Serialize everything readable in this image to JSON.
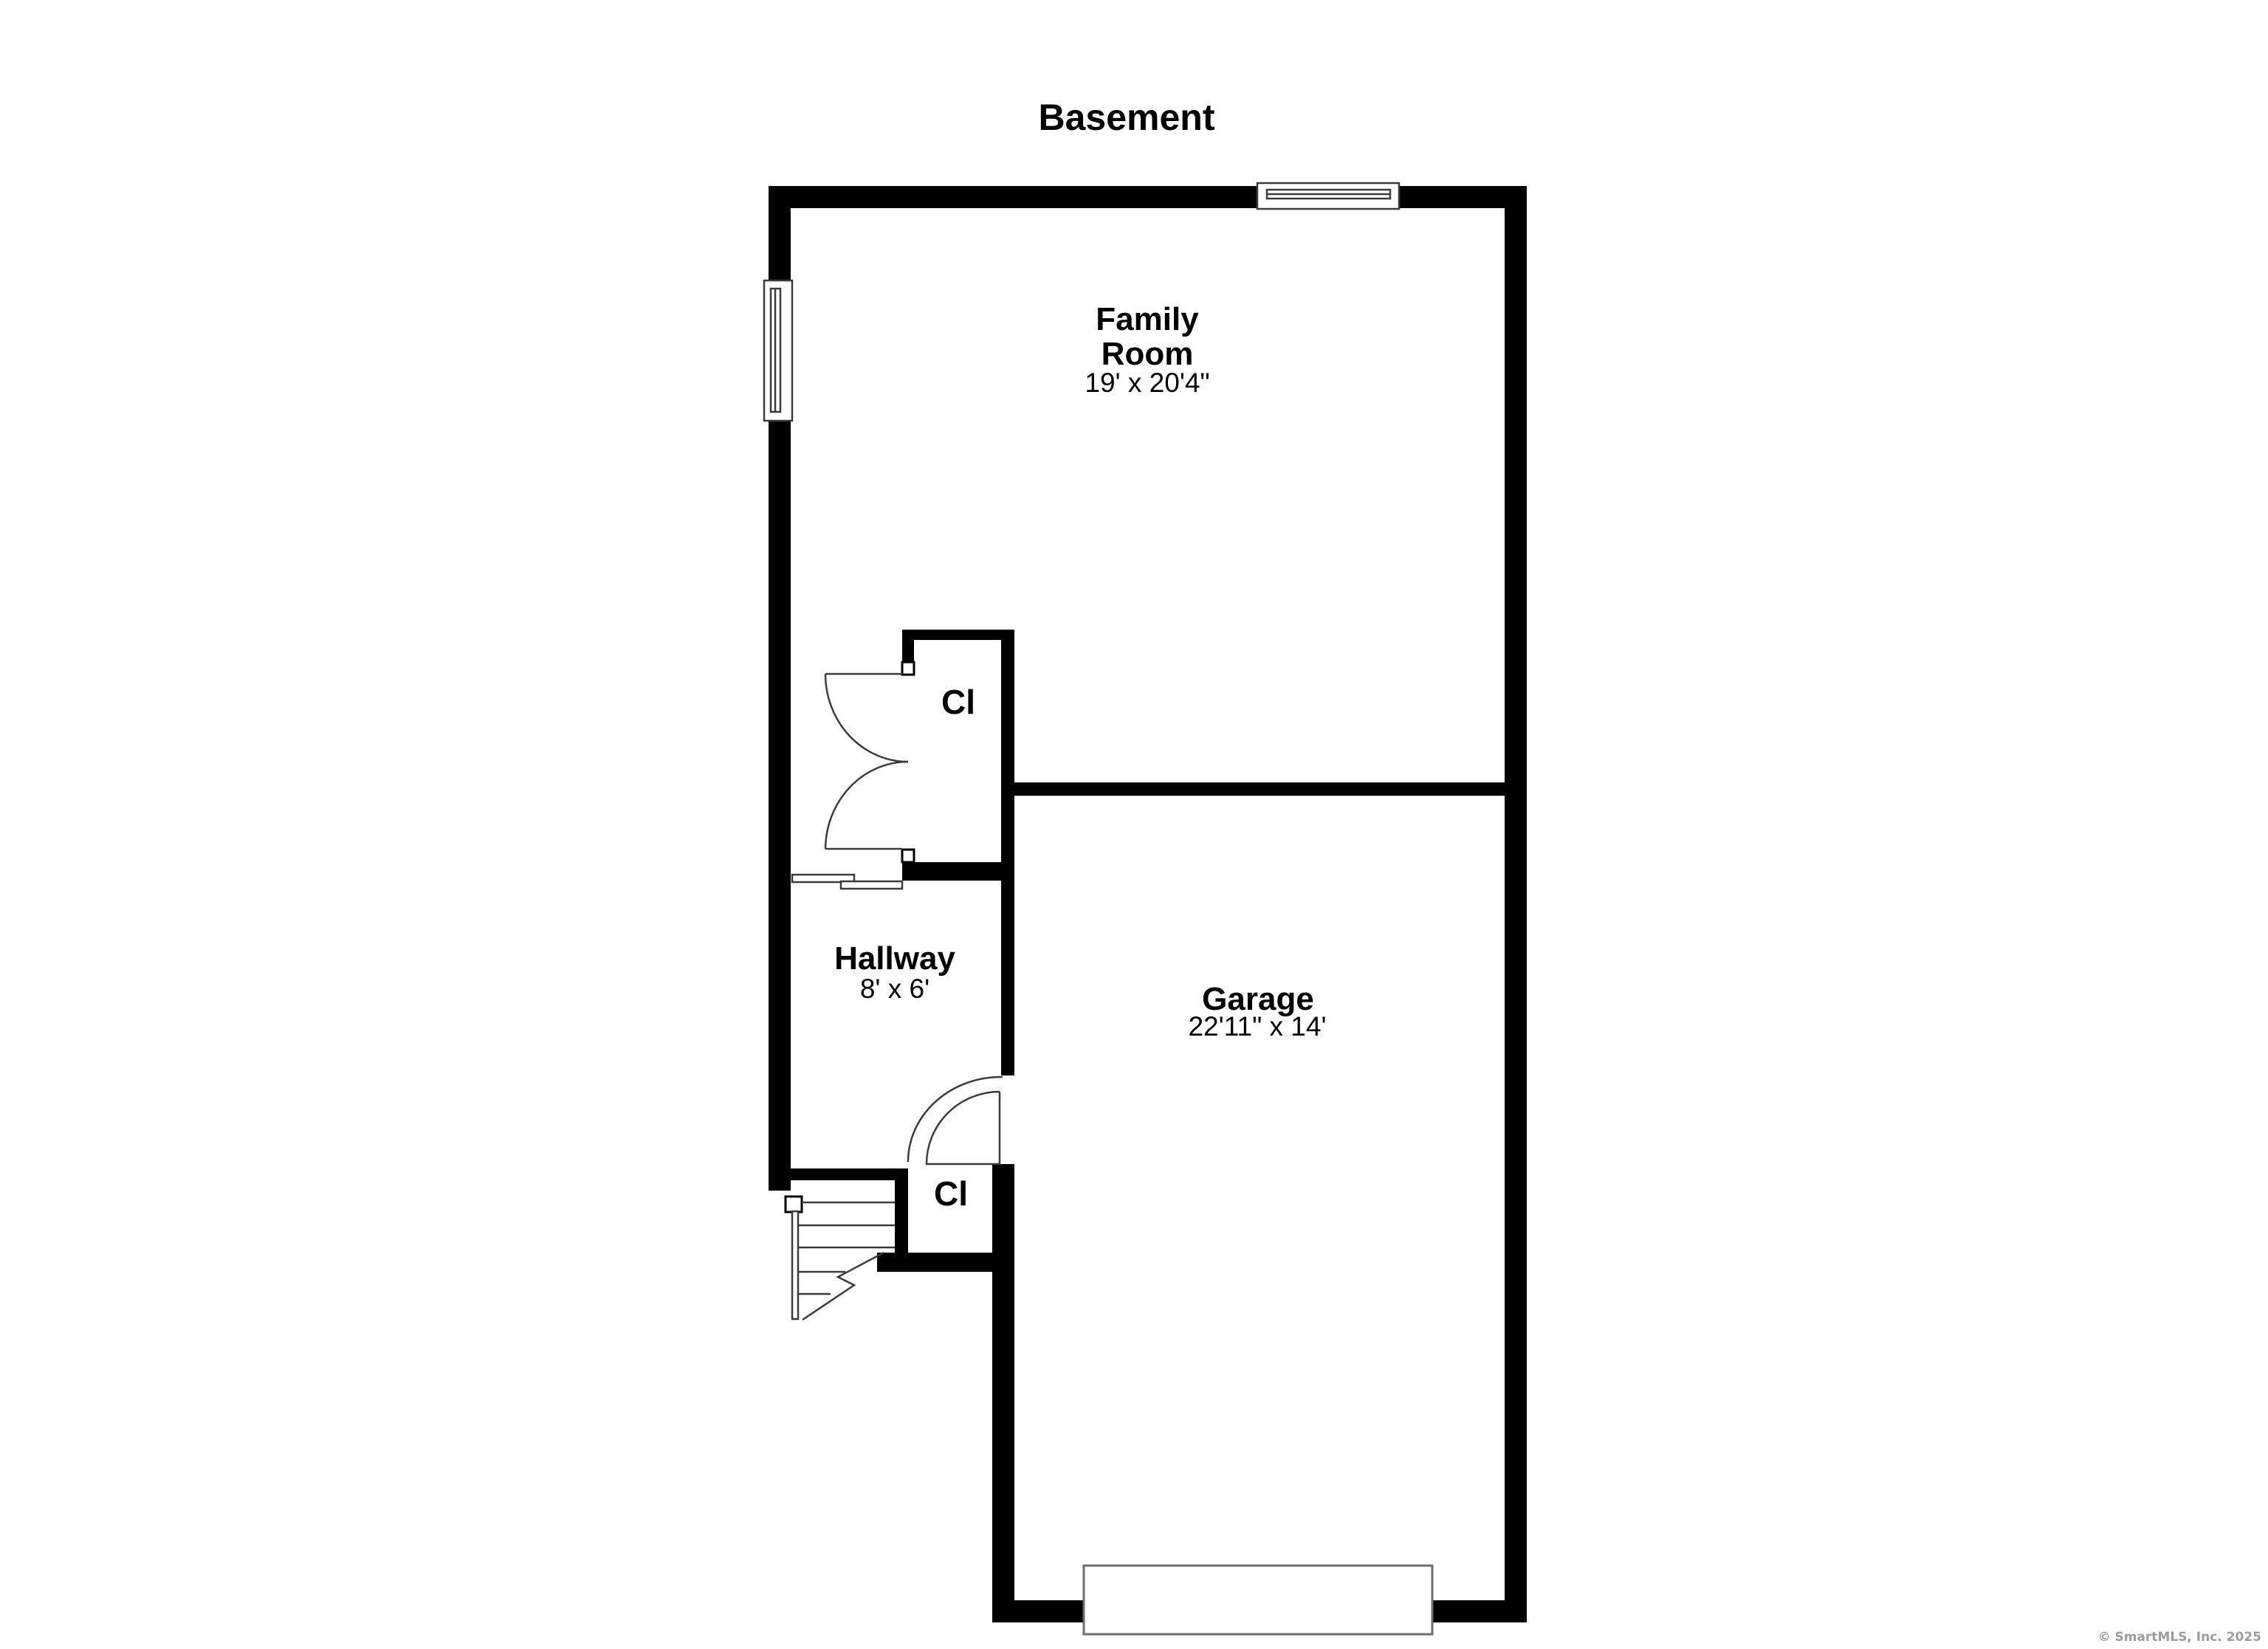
{
  "title": "Basement",
  "rooms": {
    "family_room": {
      "name_line1": "Family",
      "name_line2": "Room",
      "dimensions": "19' x 20'4\""
    },
    "hallway": {
      "name": "Hallway",
      "dimensions": "8' x 6'"
    },
    "garage": {
      "name": "Garage",
      "dimensions": "22'11\" x 14'"
    },
    "closet_upper": {
      "abbr": "Cl"
    },
    "closet_lower": {
      "abbr": "Cl"
    }
  },
  "features": {
    "windows": [
      "left-wall-window",
      "top-wall-window"
    ],
    "doors": [
      "upper-closet-double-door",
      "lower-closet-swing-door",
      "hallway-sliding-door",
      "garage-door"
    ],
    "stairs": "staircase-with-break-line"
  },
  "watermark": "© SmartMLS, Inc.  2025",
  "colors": {
    "wall": "#000000",
    "line": "#3c3c3c",
    "frame": "#6e6e6e",
    "background": "#ffffff",
    "watermark": "#9c9c9c",
    "text": "#000000"
  }
}
